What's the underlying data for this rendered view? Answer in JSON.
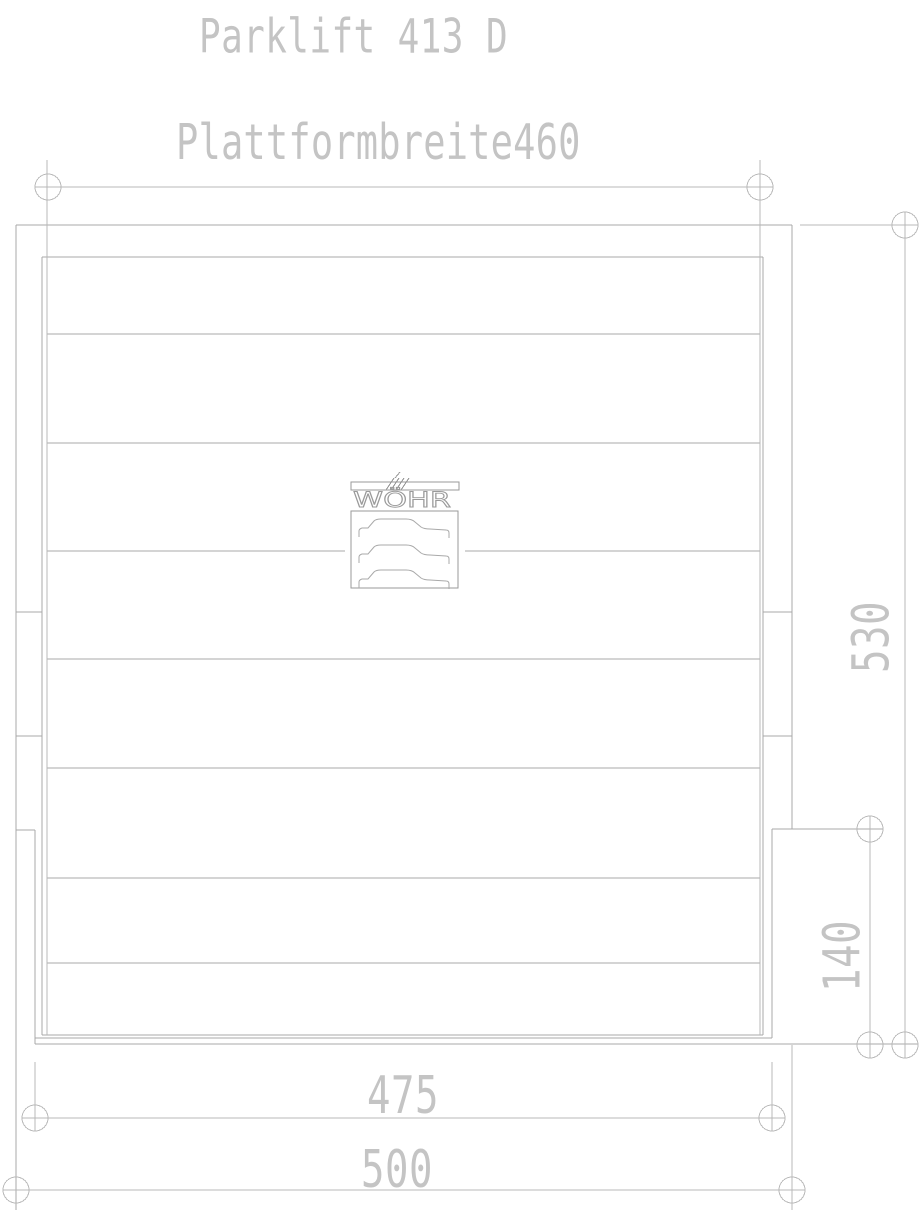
{
  "drawing": {
    "title": "Parklift 413 D",
    "subtitle": "Plattformbreite460",
    "logo": {
      "brand": "WÖHR"
    },
    "dimensions": {
      "height_530": "530",
      "height_140": "140",
      "width_475": "475",
      "width_500": "500"
    },
    "colors": {
      "line": "#a9a9a9",
      "dimension": "#b8b8b8",
      "text": "#c4c4c4",
      "logo_stroke": "#9a9a9a",
      "background": "#ffffff"
    }
  }
}
